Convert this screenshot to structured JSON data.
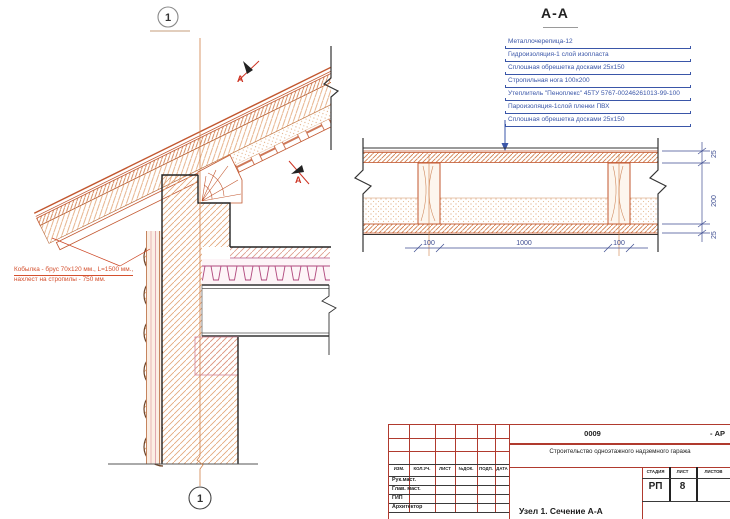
{
  "axis": {
    "marker": "1"
  },
  "marks": {
    "section_letter": "А"
  },
  "annotation": {
    "line1": "Кобылка - брус 70х120 мм., L=1500 мм.,",
    "line2": "нахлест на стропилы - 750 мм."
  },
  "section": {
    "title": "А-А",
    "callouts": [
      "Металлочерепица-12",
      "Гидроизоляция-1 слой изопласта",
      "Сплошная обрешетка досками 25х150",
      "Стропильная нога 100х200",
      "Утеплитель \"Пеноплекс\" 45ТУ 5767-00246261013-99-100",
      "Пароизоляция-1слой пленки ПВХ",
      "Сплошная обрешетка досками 25х150"
    ],
    "dims": {
      "top": "25",
      "middle": "200",
      "bottom": "25",
      "joist_left": "100",
      "span": "1000",
      "joist_right": "100"
    }
  },
  "titleblock": {
    "doc_number": "0009",
    "doc_suffix": "- АР",
    "project": "Строительство одноэтажного надземного гаража",
    "columns": [
      "ИЗМ.",
      "КОЛ.УЧ.",
      "ЛИСТ",
      "№ДОК.",
      "ПОДП.",
      "ДАТА"
    ],
    "rows": [
      "Рук.маст.",
      "Глав. маст.",
      "ГИП",
      "Архитектор"
    ],
    "stage_label": "СТАДИЯ",
    "sheet_label": "ЛИСТ",
    "sheets_label": "ЛИСТОВ",
    "stage_value": "РП",
    "sheet_value": "8",
    "drawing_title": "Узел 1.  Сечение А-А"
  },
  "colors": {
    "accent_orange": "#c2572f",
    "hatch_orange": "#e0a070",
    "annotation_red": "#d4502e",
    "callout_blue": "#3a56a8",
    "dimension_navy": "#3f4e92",
    "deck_magenta": "#b0487d",
    "stamp_red": "#b03a2e",
    "line_black": "#333333"
  }
}
